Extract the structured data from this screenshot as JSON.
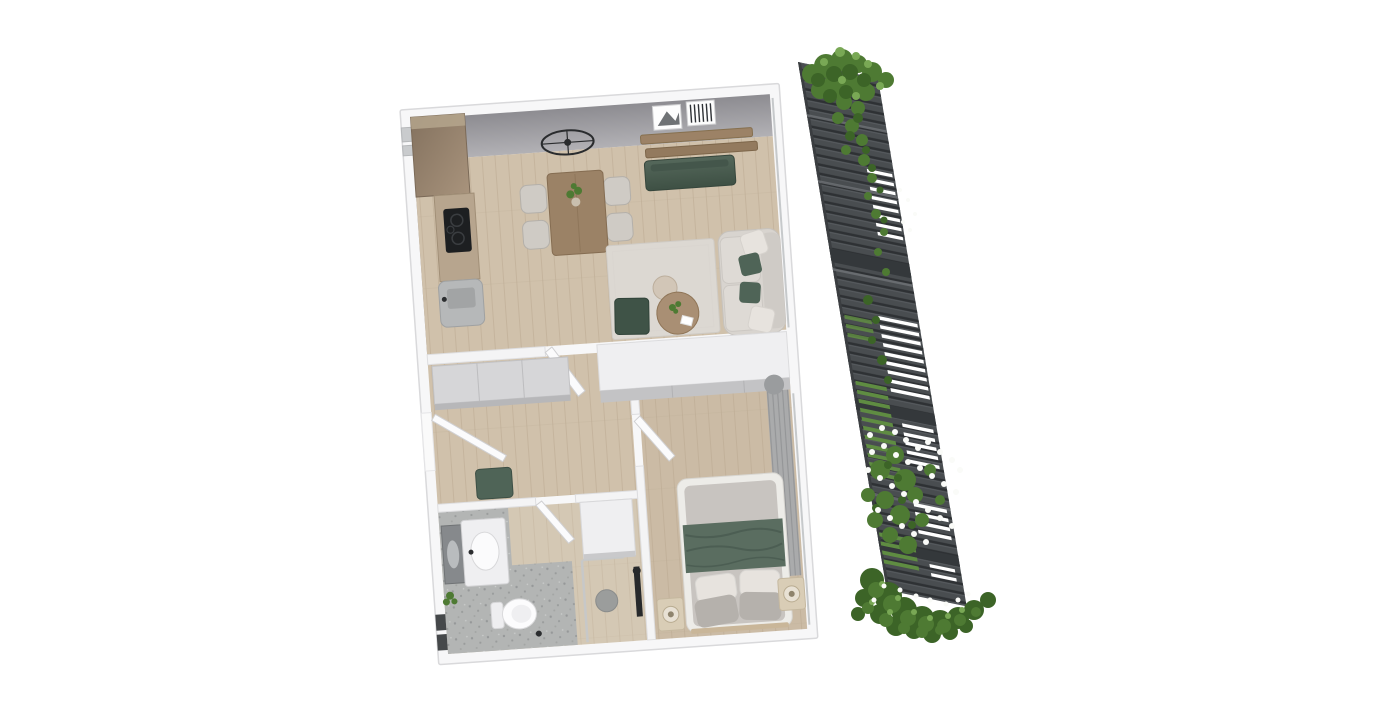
{
  "scene": {
    "title": "Apartment 3D floor plan render",
    "style": "top-down axonometric architectural visualization on white background",
    "plan_rotation_deg": -4,
    "has_text": false
  },
  "colors": {
    "background": "#ffffff",
    "wall_white": "#f7f7f8",
    "wall_edge": "#d9d9db",
    "floor_wood": "#d0c1ab",
    "floor_bedroom": "#cbbba5",
    "floor_bath": "#d4c8b4",
    "terrazzo": "#b3b5b4",
    "rug": "#dcd8d2",
    "sofa": "#d8d4cf",
    "cushion_white": "#e7e3de",
    "pillow_gray": "#b5b1ac",
    "mattress": "#c8c4c0",
    "green_textile": "#4f6457",
    "green_blanket": "#5a6d60",
    "green_dark": "#3f5347",
    "wood_mid": "#9b8266",
    "wood_light": "#b7a58e",
    "nightstand": "#d9cdb6",
    "curtain": "#a8aaac",
    "cabinet_white": "#efeff1",
    "cabinet_gray": "#d6d6d8",
    "fence": "#494d50",
    "fence_slat": "#2e3134",
    "fence_highlight": "#6e7276",
    "grass": "#5f8c42",
    "leaf_dark": "#3c6427",
    "leaf_mid": "#4e7a33",
    "leaf_light": "#79a855",
    "flower_white": "#fafbf8",
    "glass": "#c6c9cb",
    "black_fixture": "#27292b",
    "lamp_black": "#2a2c2e"
  },
  "rooms": [
    {
      "id": "living-dining-kitchen",
      "label": "Living / dining / kitchen",
      "furniture": [
        "tall kitchen unit",
        "kitchen counter with black cooktop",
        "grey kitchen base cabinet",
        "wood dining table with plant",
        "four dining chairs",
        "round wireframe ceiling lamp",
        "wall shelves",
        "two picture frames",
        "green tv sideboard",
        "cream sofa with white and green cushions",
        "light area rug",
        "round wood coffee table",
        "small side table",
        "dark green pouf"
      ]
    },
    {
      "id": "hallway",
      "label": "Hallway",
      "furniture": [
        "grey sliding wardrobe",
        "open entrance door",
        "open interior door",
        "green bench"
      ]
    },
    {
      "id": "bathroom",
      "label": "Bathroom",
      "furniture": [
        "wall mirror",
        "vanity with oval sink",
        "toilet",
        "walk-in shower with glass panel",
        "tall white cabinet",
        "open door",
        "small plant",
        "terrazzo floor zone"
      ]
    },
    {
      "id": "bedroom",
      "label": "Bedroom",
      "furniture": [
        "built-in white wardrobe",
        "double bed with green throw",
        "two white pillows",
        "two grey pillows",
        "two wood nightstands with lamps",
        "grey curtains along glazing",
        "open door"
      ]
    }
  ],
  "balcony": {
    "label": "Balcony privacy screen",
    "elements": [
      "dark horizontal slatted screen",
      "see-through white gaps",
      "greenery behind slats",
      "climbing ivy at top",
      "white flowering shrub mid-height",
      "green bush spilling over bottom"
    ]
  }
}
